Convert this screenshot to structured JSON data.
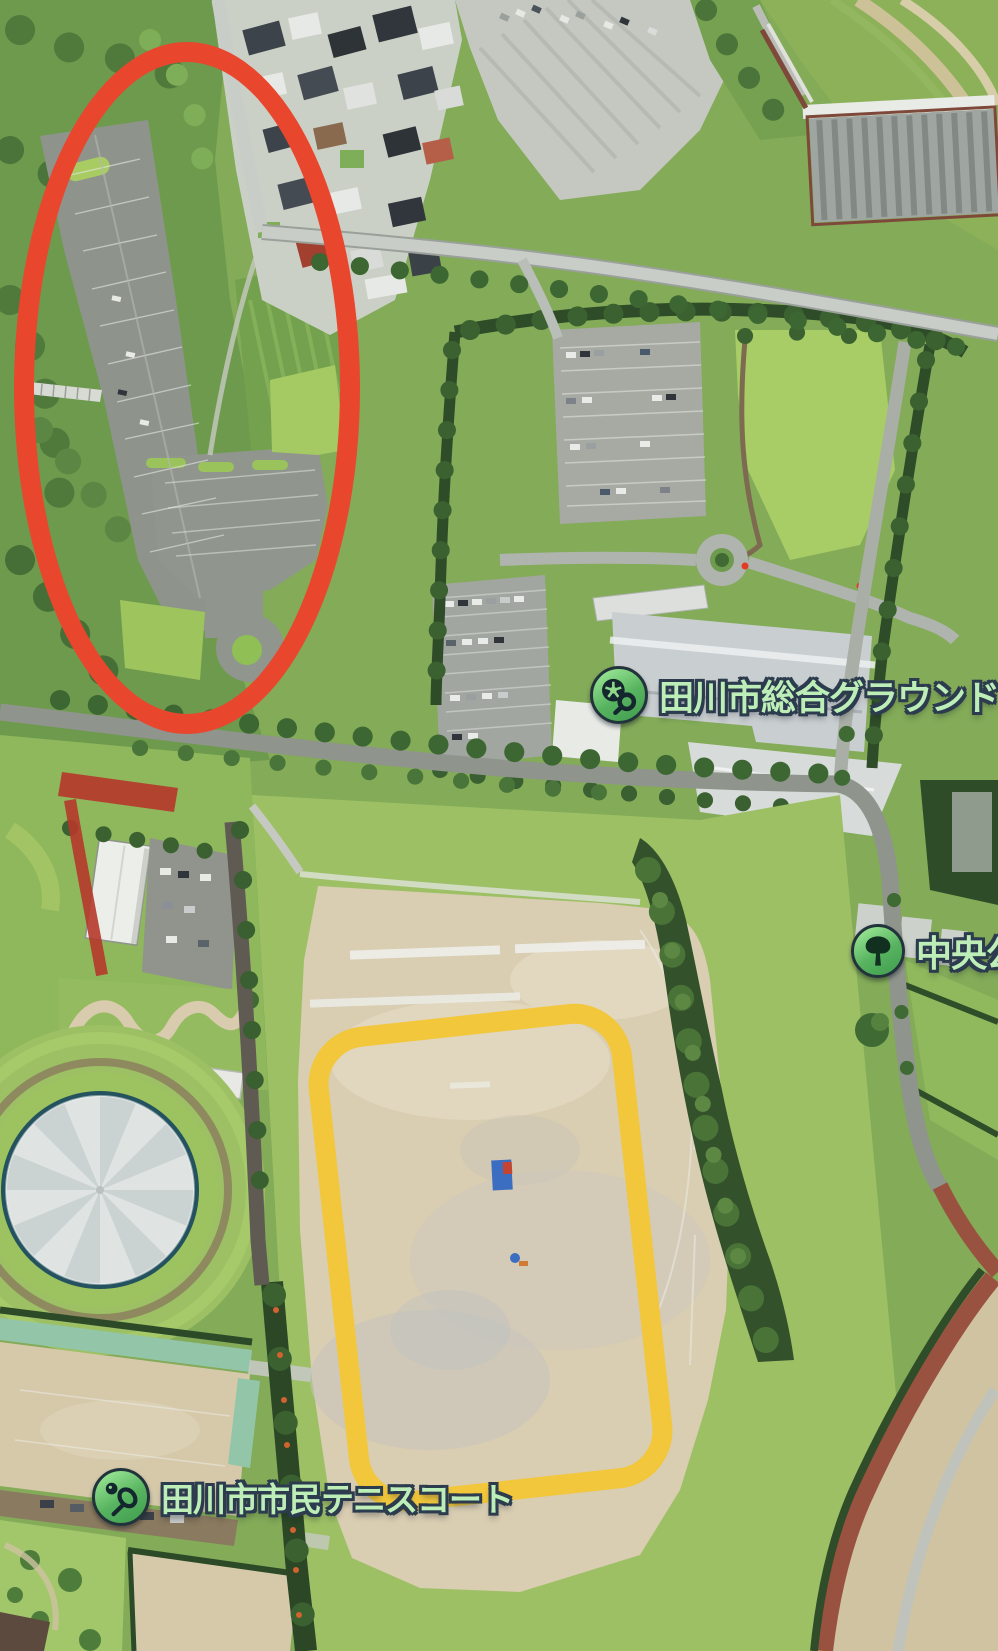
{
  "map_labels": {
    "sports_ground": {
      "text": "田川市総合グラウンド",
      "icon": "soccer-ball-search-icon"
    },
    "central_park": {
      "text": "中央公",
      "icon": "park-tree-icon"
    },
    "tennis_courts": {
      "text": "田川市市民テニスコート",
      "icon": "tennis-racket-icon"
    }
  },
  "annotations": {
    "red_ellipse": {
      "shape": "ellipse",
      "stroke_color": "#E8462D"
    },
    "yellow_rounded_rectangle": {
      "shape": "rounded-rectangle",
      "stroke_color": "#F2C73B"
    }
  },
  "label_style": {
    "text_color": "#BDEEB7",
    "outline_color": "#2C3C4E",
    "icon_ring_color": "#22333B",
    "icon_green_top": "#9AE695",
    "icon_green_bottom": "#3F9D4E",
    "glyph_color": "#14262E"
  }
}
